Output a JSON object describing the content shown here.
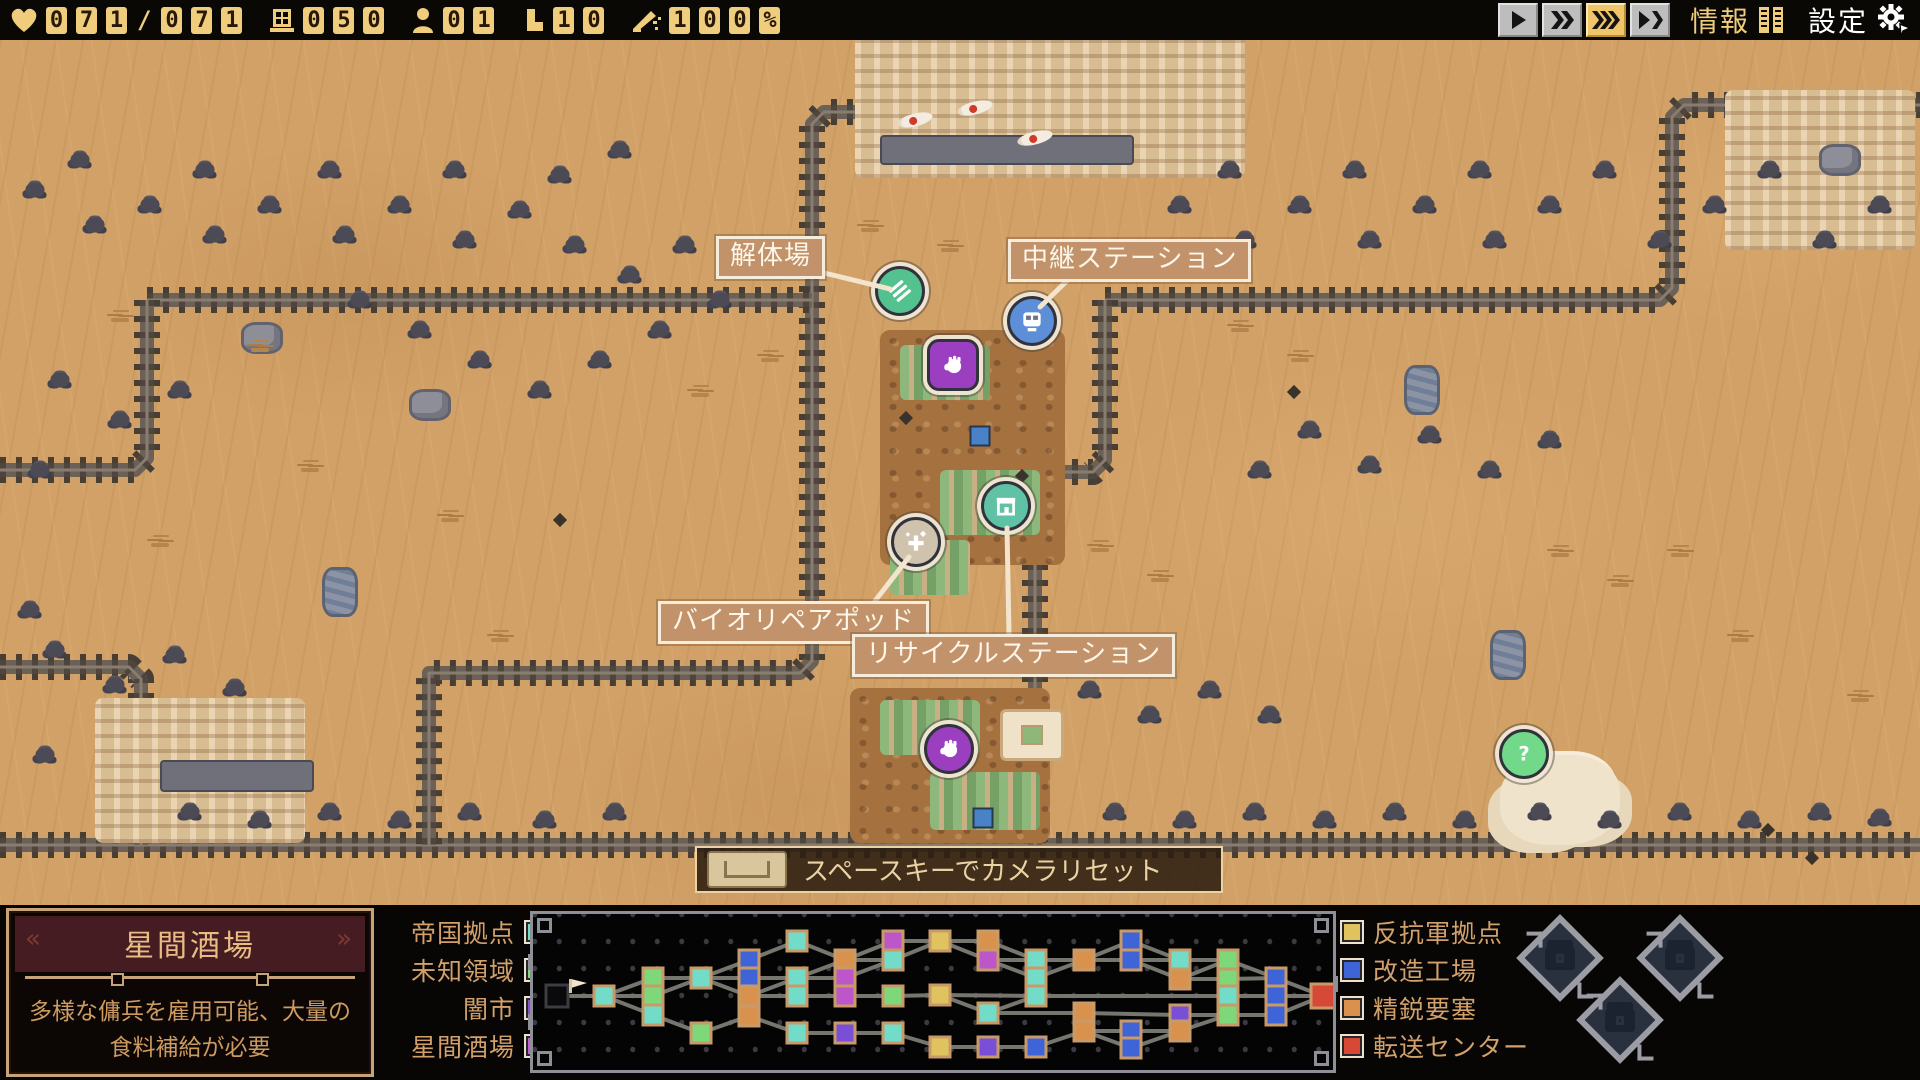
{
  "hud": {
    "resources": [
      {
        "icon": "heart-icon",
        "name": "hp",
        "value": "071/071"
      },
      {
        "icon": "window-icon",
        "name": "supplies",
        "value": "050"
      },
      {
        "icon": "person-icon",
        "name": "crew",
        "value": "01"
      },
      {
        "icon": "boot-icon",
        "name": "parts",
        "value": "10"
      },
      {
        "icon": "quill-icon",
        "name": "morale",
        "value": "100%"
      }
    ],
    "speed_buttons": [
      {
        "name": "speed-play",
        "glyph": "play",
        "active": false
      },
      {
        "name": "speed-fast",
        "glyph": "ff2",
        "active": false
      },
      {
        "name": "speed-faster",
        "glyph": "ff3",
        "active": true
      },
      {
        "name": "speed-skip",
        "glyph": "playskip",
        "active": false
      }
    ],
    "info_label": "情報",
    "settings_label": "設定"
  },
  "map": {
    "labels": [
      {
        "id": "dismantle",
        "text": "解体場",
        "x": 716,
        "y": 236,
        "line": [
          812,
          270,
          890,
          289
        ]
      },
      {
        "id": "relay",
        "text": "中継ステーション",
        "x": 1008,
        "y": 239,
        "line": [
          1075,
          273,
          1040,
          307
        ]
      },
      {
        "id": "biorepair",
        "text": "バイオリペアポッド",
        "x": 658,
        "y": 601,
        "line": [
          875,
          601,
          909,
          557
        ]
      },
      {
        "id": "recycle",
        "text": "リサイクルステーション",
        "x": 852,
        "y": 634,
        "line": [
          1009,
          634,
          1007,
          528
        ]
      }
    ],
    "markers": [
      {
        "id": "dismantle-marker",
        "shape": "circle",
        "color": "#54c28e",
        "x": 900,
        "y": 291,
        "glyph": "scrap"
      },
      {
        "id": "relay-marker",
        "shape": "circle",
        "color": "#5c8fd8",
        "x": 1032,
        "y": 321,
        "glyph": "train"
      },
      {
        "id": "pad-marker-top",
        "shape": "square",
        "color": "#9b3fc0",
        "x": 953,
        "y": 365,
        "glyph": "hand"
      },
      {
        "id": "biorepair-marker",
        "shape": "circle",
        "color": "#cfc3ae",
        "x": 916,
        "y": 542,
        "glyph": "sparkle"
      },
      {
        "id": "recycle-marker",
        "shape": "circle",
        "color": "#5fc2a4",
        "x": 1006,
        "y": 506,
        "glyph": "shop"
      },
      {
        "id": "pad-marker-low",
        "shape": "circle",
        "color": "#9b3fc0",
        "x": 949,
        "y": 749,
        "glyph": "hand"
      },
      {
        "id": "unknown-marker",
        "shape": "circle",
        "color": "#72d98b",
        "x": 1524,
        "y": 754,
        "glyph": "question"
      }
    ],
    "unknown_glyph": "?",
    "tracks": [
      [
        [
          0,
          845
        ],
        [
          1920,
          845
        ]
      ],
      [
        [
          1100,
          0
        ],
        [
          1100,
          100
        ],
        [
          1088,
          112
        ],
        [
          824,
          112
        ],
        [
          812,
          124
        ],
        [
          812,
          661
        ],
        [
          800,
          673
        ],
        [
          429,
          673
        ],
        [
          429,
          845
        ]
      ],
      [
        [
          147,
          300
        ],
        [
          812,
          300
        ]
      ],
      [
        [
          147,
          300
        ],
        [
          147,
          458
        ],
        [
          135,
          470
        ],
        [
          0,
          470
        ]
      ],
      [
        [
          0,
          667
        ],
        [
          129,
          667
        ],
        [
          141,
          679
        ],
        [
          141,
          845
        ]
      ],
      [
        [
          1105,
          300
        ],
        [
          1660,
          300
        ],
        [
          1672,
          288
        ],
        [
          1672,
          117
        ],
        [
          1684,
          105
        ],
        [
          1920,
          105
        ]
      ],
      [
        [
          1105,
          300
        ],
        [
          1105,
          460
        ],
        [
          1093,
          472
        ],
        [
          1047,
          472
        ],
        [
          1035,
          484
        ],
        [
          1035,
          845
        ]
      ]
    ],
    "scenery": [
      [
        "ruin",
        855,
        28,
        390,
        150
      ],
      [
        "ruin",
        1725,
        90,
        190,
        160
      ],
      [
        "ruin",
        95,
        698,
        210,
        145
      ],
      [
        "dirt",
        880,
        330,
        185,
        235
      ],
      [
        "crops",
        900,
        345,
        90,
        55
      ],
      [
        "crops",
        940,
        470,
        100,
        65
      ],
      [
        "crops",
        890,
        540,
        80,
        55
      ],
      [
        "dirt",
        850,
        688,
        200,
        155
      ],
      [
        "crops",
        880,
        700,
        100,
        55
      ],
      [
        "crops",
        930,
        772,
        110,
        58
      ],
      [
        "bone",
        1500,
        755,
        120,
        90
      ],
      [
        "wreck",
        880,
        135,
        250,
        26
      ],
      [
        "wreck",
        160,
        760,
        150,
        28
      ],
      [
        "fish",
        915,
        120
      ],
      [
        "fish",
        975,
        108
      ],
      [
        "fish",
        1035,
        138
      ],
      [
        "crate",
        980,
        436
      ],
      [
        "crate",
        983,
        818
      ],
      [
        "pad",
        1032,
        735
      ],
      [
        "rock",
        430,
        405
      ],
      [
        "rock",
        262,
        338
      ],
      [
        "rock",
        1840,
        160
      ],
      [
        "rock2",
        1422,
        390
      ],
      [
        "rock2",
        1508,
        655
      ],
      [
        "rock2",
        340,
        592
      ],
      [
        "spark",
        906,
        418
      ],
      [
        "spark",
        1022,
        476
      ],
      [
        "spark",
        1768,
        830
      ],
      [
        "spark",
        1812,
        858
      ],
      [
        "spark",
        1294,
        392
      ],
      [
        "spark",
        560,
        520
      ],
      [
        "bush",
        35,
        190
      ],
      [
        "bush",
        80,
        160
      ],
      [
        "bush",
        95,
        225
      ],
      [
        "bush",
        150,
        205
      ],
      [
        "bush",
        205,
        170
      ],
      [
        "bush",
        215,
        235
      ],
      [
        "bush",
        270,
        205
      ],
      [
        "bush",
        330,
        170
      ],
      [
        "bush",
        345,
        235
      ],
      [
        "bush",
        400,
        205
      ],
      [
        "bush",
        455,
        170
      ],
      [
        "bush",
        465,
        240
      ],
      [
        "bush",
        520,
        210
      ],
      [
        "bush",
        575,
        245
      ],
      [
        "bush",
        630,
        275
      ],
      [
        "bush",
        685,
        245
      ],
      [
        "bush",
        560,
        175
      ],
      [
        "bush",
        620,
        150
      ],
      [
        "bush",
        735,
        265
      ],
      [
        "bush",
        360,
        300
      ],
      [
        "bush",
        420,
        330
      ],
      [
        "bush",
        480,
        360
      ],
      [
        "bush",
        540,
        390
      ],
      [
        "bush",
        600,
        360
      ],
      [
        "bush",
        660,
        330
      ],
      [
        "bush",
        720,
        300
      ],
      [
        "bush",
        60,
        380
      ],
      [
        "bush",
        120,
        420
      ],
      [
        "bush",
        40,
        470
      ],
      [
        "bush",
        180,
        390
      ],
      [
        "bush",
        1180,
        205
      ],
      [
        "bush",
        1230,
        170
      ],
      [
        "bush",
        1245,
        240
      ],
      [
        "bush",
        1300,
        205
      ],
      [
        "bush",
        1355,
        170
      ],
      [
        "bush",
        1370,
        240
      ],
      [
        "bush",
        1425,
        205
      ],
      [
        "bush",
        1480,
        170
      ],
      [
        "bush",
        1495,
        240
      ],
      [
        "bush",
        1550,
        205
      ],
      [
        "bush",
        1605,
        170
      ],
      [
        "bush",
        1660,
        240
      ],
      [
        "bush",
        1715,
        205
      ],
      [
        "bush",
        1770,
        170
      ],
      [
        "bush",
        1825,
        240
      ],
      [
        "bush",
        1880,
        205
      ],
      [
        "bush",
        1310,
        430
      ],
      [
        "bush",
        1370,
        465
      ],
      [
        "bush",
        1430,
        435
      ],
      [
        "bush",
        1490,
        470
      ],
      [
        "bush",
        1550,
        440
      ],
      [
        "bush",
        1260,
        470
      ],
      [
        "bush",
        55,
        650
      ],
      [
        "bush",
        115,
        685
      ],
      [
        "bush",
        175,
        655
      ],
      [
        "bush",
        235,
        688
      ],
      [
        "bush",
        45,
        755
      ],
      [
        "bush",
        30,
        610
      ],
      [
        "bush",
        1090,
        690
      ],
      [
        "bush",
        1150,
        715
      ],
      [
        "bush",
        1210,
        690
      ],
      [
        "bush",
        1270,
        715
      ],
      [
        "bush",
        190,
        812
      ],
      [
        "bush",
        260,
        820
      ],
      [
        "bush",
        330,
        812
      ],
      [
        "bush",
        400,
        820
      ],
      [
        "bush",
        470,
        812
      ],
      [
        "bush",
        545,
        820
      ],
      [
        "bush",
        615,
        812
      ],
      [
        "bush",
        1115,
        812
      ],
      [
        "bush",
        1185,
        820
      ],
      [
        "bush",
        1255,
        812
      ],
      [
        "bush",
        1325,
        820
      ],
      [
        "bush",
        1395,
        812
      ],
      [
        "bush",
        1465,
        820
      ],
      [
        "bush",
        1540,
        812
      ],
      [
        "bush",
        1610,
        820
      ],
      [
        "bush",
        1680,
        812
      ],
      [
        "bush",
        1750,
        820
      ],
      [
        "bush",
        1820,
        812
      ],
      [
        "bush",
        1880,
        818
      ],
      [
        "grass",
        260,
        350
      ],
      [
        "grass",
        310,
        470
      ],
      [
        "grass",
        160,
        545
      ],
      [
        "grass",
        450,
        520
      ],
      [
        "grass",
        700,
        395
      ],
      [
        "grass",
        770,
        360
      ],
      [
        "grass",
        1240,
        330
      ],
      [
        "grass",
        1300,
        360
      ],
      [
        "grass",
        1560,
        555
      ],
      [
        "grass",
        1620,
        585
      ],
      [
        "grass",
        1680,
        555
      ],
      [
        "grass",
        120,
        320
      ],
      [
        "grass",
        870,
        230
      ],
      [
        "grass",
        1100,
        550
      ],
      [
        "grass",
        1160,
        580
      ],
      [
        "grass",
        500,
        640
      ],
      [
        "grass",
        1740,
        640
      ],
      [
        "grass",
        1860,
        700
      ],
      [
        "grass",
        950,
        250
      ]
    ]
  },
  "hint": {
    "key": "space-key",
    "text": "スペースキーでカメラリセット"
  },
  "info_card": {
    "title": "星間酒場",
    "description": "多様な傭兵を雇用可能、大量の\n食料補給が必要"
  },
  "legend_left": [
    {
      "label": "帝国拠点",
      "color": "#72dcc8"
    },
    {
      "label": "未知領域",
      "color": "#7ed87a"
    },
    {
      "label": "闇市",
      "color": "#8a4fd8"
    },
    {
      "label": "星間酒場",
      "color": "#c35fd3"
    }
  ],
  "legend_right": [
    {
      "label": "反抗軍拠点",
      "color": "#dec35e"
    },
    {
      "label": "改造工場",
      "color": "#3f64d8"
    },
    {
      "label": "精鋭要塞",
      "color": "#d9924e"
    },
    {
      "label": "転送センター",
      "color": "#d84836"
    }
  ],
  "network": {
    "palette": {
      "cyan": "#72dcc8",
      "green": "#7ed87a",
      "blue": "#3f64d8",
      "orange": "#d9924e",
      "magenta": "#bd56c8",
      "violet": "#7a4fd8",
      "yellow": "#dec35e",
      "red": "#d84836",
      "start": "#0a0a0a",
      "node_border": "#c89a68"
    },
    "nodes": [
      [
        554,
        993,
        "start"
      ],
      [
        601,
        993,
        "cyan"
      ],
      [
        650,
        975,
        "green"
      ],
      [
        650,
        993,
        "green"
      ],
      [
        650,
        1012,
        "cyan"
      ],
      [
        698,
        975,
        "cyan"
      ],
      [
        698,
        1030,
        "green"
      ],
      [
        746,
        957,
        "blue"
      ],
      [
        746,
        975,
        "blue"
      ],
      [
        746,
        993,
        "orange"
      ],
      [
        746,
        1013,
        "orange"
      ],
      [
        794,
        938,
        "cyan"
      ],
      [
        794,
        975,
        "cyan"
      ],
      [
        794,
        993,
        "cyan"
      ],
      [
        794,
        1030,
        "cyan"
      ],
      [
        842,
        957,
        "orange"
      ],
      [
        842,
        975,
        "magenta"
      ],
      [
        842,
        993,
        "magenta"
      ],
      [
        842,
        1030,
        "violet"
      ],
      [
        890,
        938,
        "magenta"
      ],
      [
        890,
        957,
        "cyan"
      ],
      [
        890,
        993,
        "green"
      ],
      [
        890,
        1030,
        "cyan"
      ],
      [
        937,
        938,
        "yellow"
      ],
      [
        937,
        992,
        "yellow"
      ],
      [
        937,
        1044,
        "yellow"
      ],
      [
        985,
        938,
        "orange"
      ],
      [
        985,
        957,
        "magenta"
      ],
      [
        985,
        1010,
        "cyan"
      ],
      [
        985,
        1044,
        "violet"
      ],
      [
        1033,
        957,
        "cyan"
      ],
      [
        1033,
        975,
        "cyan"
      ],
      [
        1033,
        993,
        "cyan"
      ],
      [
        1033,
        1044,
        "blue"
      ],
      [
        1081,
        957,
        "orange"
      ],
      [
        1081,
        1010,
        "orange"
      ],
      [
        1081,
        1028,
        "orange"
      ],
      [
        1128,
        938,
        "blue"
      ],
      [
        1128,
        957,
        "blue"
      ],
      [
        1128,
        1028,
        "blue"
      ],
      [
        1128,
        1045,
        "blue"
      ],
      [
        1177,
        957,
        "cyan"
      ],
      [
        1177,
        976,
        "orange"
      ],
      [
        1177,
        1012,
        "violet"
      ],
      [
        1177,
        1028,
        "orange"
      ],
      [
        1225,
        957,
        "green"
      ],
      [
        1225,
        976,
        "green"
      ],
      [
        1225,
        993,
        "cyan"
      ],
      [
        1225,
        1012,
        "green"
      ],
      [
        1273,
        975,
        "blue"
      ],
      [
        1273,
        993,
        "blue"
      ],
      [
        1273,
        1012,
        "blue"
      ],
      [
        1320,
        993,
        "red"
      ]
    ],
    "edges": [
      [
        0,
        1
      ],
      [
        1,
        2
      ],
      [
        1,
        3
      ],
      [
        1,
        4
      ],
      [
        2,
        5
      ],
      [
        3,
        5
      ],
      [
        4,
        6
      ],
      [
        5,
        7
      ],
      [
        5,
        8
      ],
      [
        5,
        9
      ],
      [
        6,
        10
      ],
      [
        7,
        11
      ],
      [
        8,
        12
      ],
      [
        9,
        12
      ],
      [
        9,
        13
      ],
      [
        10,
        14
      ],
      [
        11,
        15
      ],
      [
        12,
        15
      ],
      [
        12,
        16
      ],
      [
        13,
        17
      ],
      [
        14,
        18
      ],
      [
        15,
        19
      ],
      [
        15,
        20
      ],
      [
        16,
        20
      ],
      [
        17,
        21
      ],
      [
        18,
        22
      ],
      [
        19,
        23
      ],
      [
        20,
        23
      ],
      [
        21,
        24
      ],
      [
        22,
        25
      ],
      [
        23,
        26
      ],
      [
        23,
        27
      ],
      [
        24,
        28
      ],
      [
        24,
        32
      ],
      [
        25,
        29
      ],
      [
        26,
        30
      ],
      [
        27,
        30
      ],
      [
        27,
        31
      ],
      [
        28,
        32
      ],
      [
        29,
        33
      ],
      [
        30,
        34
      ],
      [
        31,
        34
      ],
      [
        28,
        35
      ],
      [
        33,
        36
      ],
      [
        34,
        37
      ],
      [
        34,
        38
      ],
      [
        35,
        43
      ],
      [
        36,
        39
      ],
      [
        36,
        40
      ],
      [
        37,
        41
      ],
      [
        38,
        41
      ],
      [
        38,
        42
      ],
      [
        39,
        44
      ],
      [
        40,
        44
      ],
      [
        41,
        45
      ],
      [
        42,
        45
      ],
      [
        42,
        46
      ],
      [
        32,
        47
      ],
      [
        43,
        48
      ],
      [
        44,
        48
      ],
      [
        45,
        49
      ],
      [
        46,
        49
      ],
      [
        47,
        50
      ],
      [
        48,
        51
      ],
      [
        49,
        52
      ],
      [
        50,
        52
      ],
      [
        51,
        52
      ]
    ],
    "flag": [
      568,
      976
    ]
  },
  "cargo_slots": [
    {
      "x": 1560,
      "y": 958
    },
    {
      "x": 1680,
      "y": 958
    },
    {
      "x": 1620,
      "y": 1020
    }
  ]
}
